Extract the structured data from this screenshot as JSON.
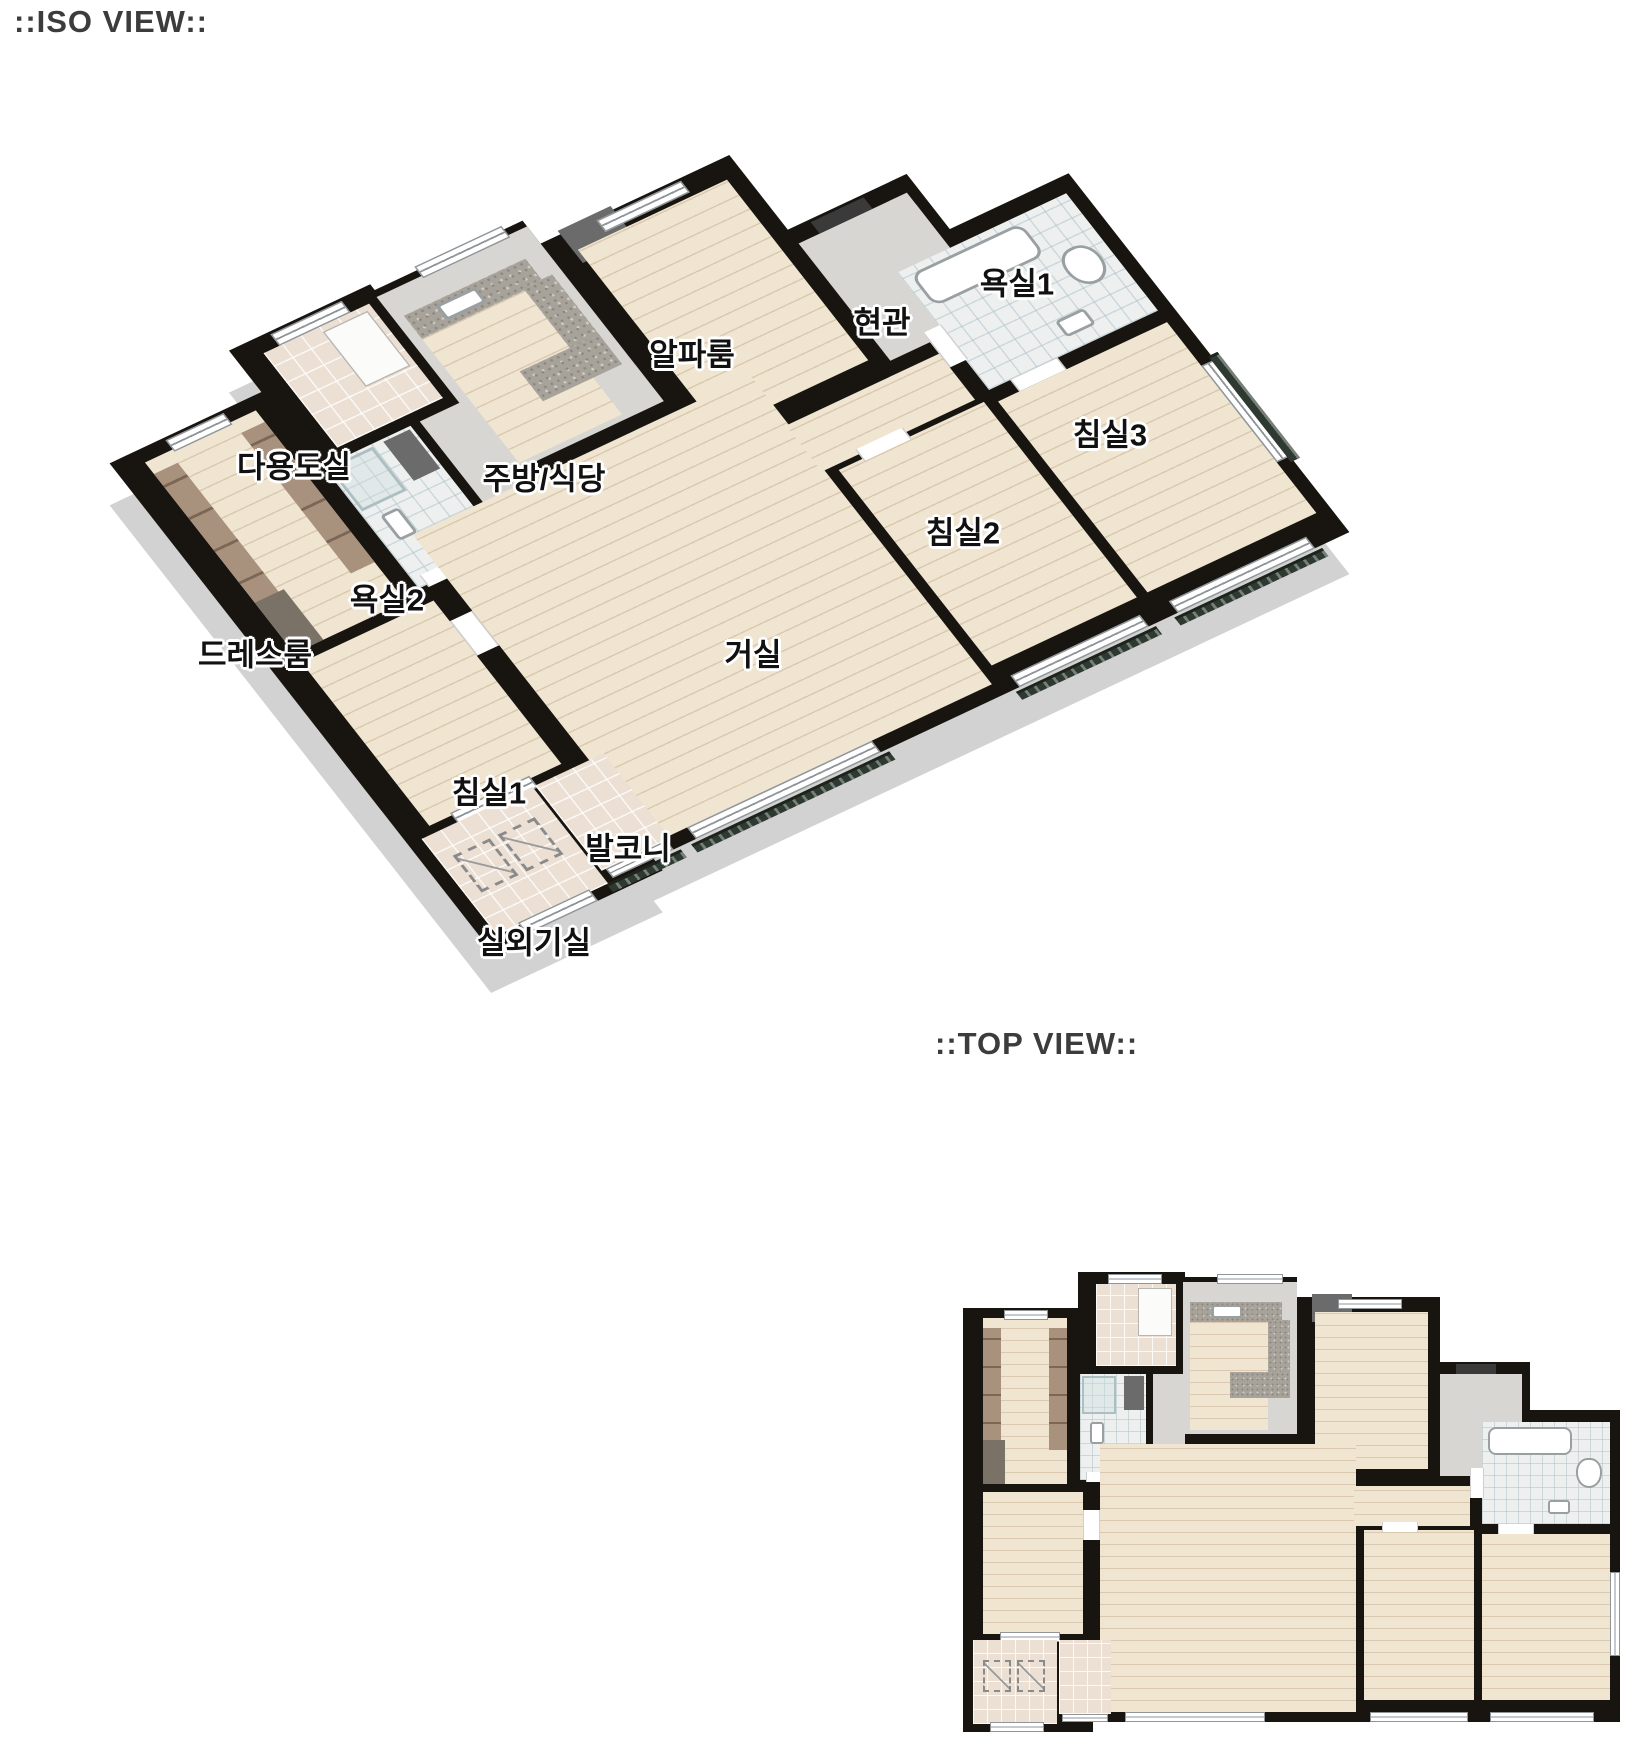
{
  "iso_view": {
    "title": "::ISO VIEW::",
    "labels": [
      {
        "id": "alpha-room",
        "text": "알파룸"
      },
      {
        "id": "entrance",
        "text": "현관"
      },
      {
        "id": "bathroom-1",
        "text": "욕실1"
      },
      {
        "id": "bedroom-3",
        "text": "침실3"
      },
      {
        "id": "utility-room",
        "text": "다용도실"
      },
      {
        "id": "kitchen-dining",
        "text": "주방/식당"
      },
      {
        "id": "bathroom-2",
        "text": "욕실2"
      },
      {
        "id": "dress-room",
        "text": "드레스룸"
      },
      {
        "id": "living-room",
        "text": "거실"
      },
      {
        "id": "bedroom-2",
        "text": "침실2"
      },
      {
        "id": "bedroom-1",
        "text": "침실1"
      },
      {
        "id": "balcony",
        "text": "발코니"
      },
      {
        "id": "outdoor-unit-room",
        "text": "실외기실"
      }
    ]
  },
  "top_view": {
    "title": "::TOP VIEW::"
  },
  "colors": {
    "wall": "#18140f",
    "wood_floor": "#f0e5d1",
    "tile_beige": "#ece0d4",
    "tile_white": "#eef0f0",
    "entry_gray": "#d8d6d2",
    "granite": "#a7a29a",
    "wardrobe": "#a8917d",
    "railing": "#2e3a31",
    "exterior_wall": "#d2d2d2",
    "label_text": "#111111",
    "title_text": "#3c3c3c"
  }
}
